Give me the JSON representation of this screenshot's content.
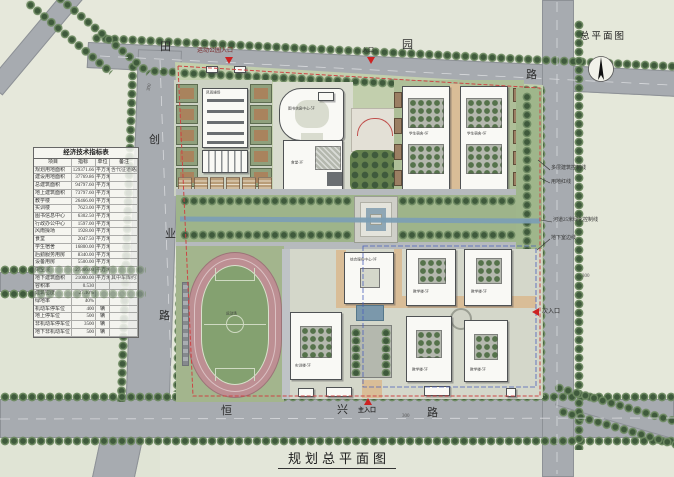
{
  "page_title": "规划总平面图",
  "compass": {
    "label": "总平面图"
  },
  "roads": {
    "top": {
      "chars": [
        "田",
        "园",
        "路"
      ]
    },
    "left": {
      "chars": [
        "创",
        "业",
        "路"
      ]
    },
    "bottom": {
      "chars": [
        "恒",
        "兴",
        "路"
      ]
    }
  },
  "entrances": {
    "sport_park_label": "运动公园入口",
    "north_label": "入口",
    "main_label": "主入口",
    "secondary_label": "次入口"
  },
  "annotations": {
    "multi_storey_line": "多层建筑控制线",
    "red_line": "用地红线",
    "river_line": "河道25米绿化控制线",
    "basement_line": "地下室边线",
    "dim_left": "300",
    "dim_right": "300",
    "dim_bottom": "300"
  },
  "buildings": {
    "gym": "风雨操场",
    "library": "图书信息中心-5F",
    "canteen": "食堂-3F",
    "dorm_a": "学生宿舍-6F",
    "dorm_b": "学生宿舍-6F",
    "service": "综合服务中心-9F",
    "teach1": "教学楼-5F",
    "teach2": "教学楼-5F",
    "teach3": "教学楼-5F",
    "teach4": "教学楼-5F",
    "training": "实训楼-5F",
    "field": "运动场"
  },
  "table": {
    "title": "经济技术指标表",
    "headers": [
      "项目",
      "指标",
      "单位",
      "备注"
    ],
    "rows": [
      [
        "规划用地面积",
        "129371.66",
        "平方米",
        "含代征道路用地"
      ],
      [
        "建设用地面积",
        "37769.86",
        "平方米",
        ""
      ],
      [
        "总建筑面积",
        "94797.60",
        "平方米",
        ""
      ],
      [
        "地上建筑面积",
        "73797.60",
        "平方米",
        ""
      ],
      [
        "教学楼",
        "26466.00",
        "平方米",
        ""
      ],
      [
        "实训楼",
        "7623.00",
        "平方米",
        ""
      ],
      [
        "图书信息中心",
        "6302.50",
        "平方米",
        ""
      ],
      [
        "行政办公中心",
        "1597.00",
        "平方米",
        ""
      ],
      [
        "风雨操场",
        "1928.00",
        "平方米",
        ""
      ],
      [
        "食堂",
        "2047.50",
        "平方米",
        ""
      ],
      [
        "学生宿舍",
        "16800.00",
        "平方米",
        ""
      ],
      [
        "后勤服务用房",
        "8340.00",
        "平方米",
        ""
      ],
      [
        "设备用房",
        "5500.00",
        "平方米",
        ""
      ],
      [
        "架空层",
        "27366.00",
        "平方米",
        ""
      ],
      [
        "地下建筑面积",
        "21000.00",
        "平方米",
        "其中车库约700位"
      ],
      [
        "容积率",
        "0.530",
        "",
        ""
      ],
      [
        "建筑密度",
        "27.10%",
        "",
        ""
      ],
      [
        "绿地率",
        "40%",
        "",
        ""
      ],
      [
        "机动车停车位",
        "400",
        "辆",
        ""
      ],
      [
        "地上停车位",
        "500",
        "辆",
        ""
      ],
      [
        "非机动车停车位",
        "3500",
        "辆",
        ""
      ],
      [
        "地下非机动车位",
        "500",
        "辆",
        ""
      ]
    ]
  },
  "colors": {
    "road": "#a7abb0",
    "site_green": "#c2cfad",
    "band_green": "#9fb68b",
    "track": "#bd8f93",
    "field": "#84a170",
    "water": "#7d9fb5",
    "building": "#f9f9f5",
    "tan_path": "#d9bd97",
    "red_boundary": "#cc4444",
    "blue_boundary": "#4a5fbb",
    "tree": "#3f5a3c",
    "entrance_marker": "#cc2222"
  }
}
